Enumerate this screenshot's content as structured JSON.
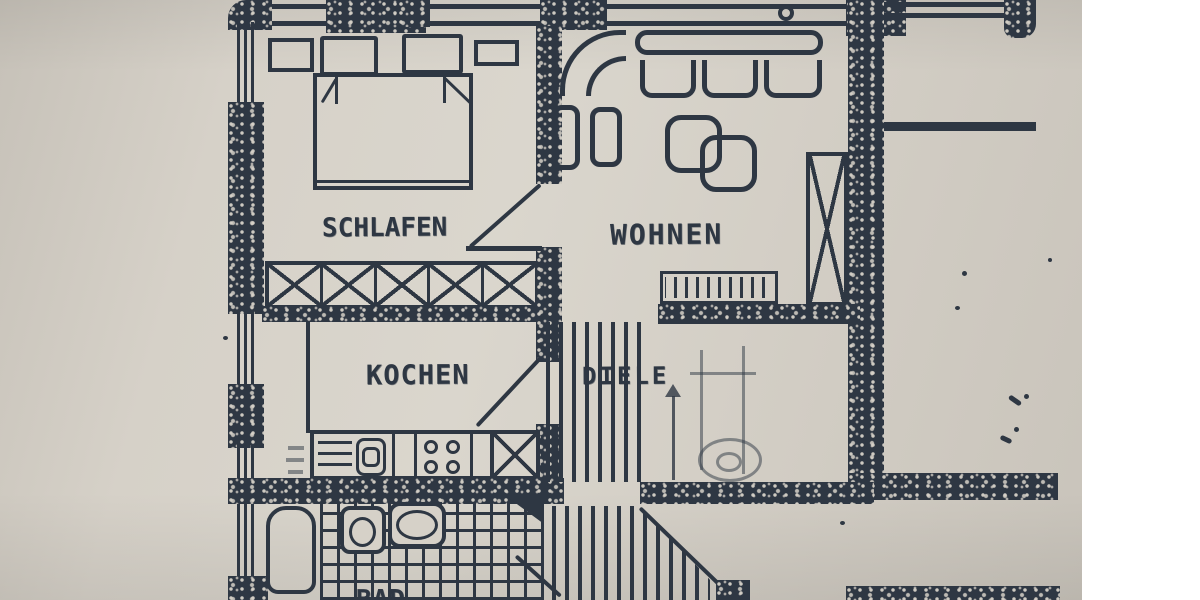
{
  "document": {
    "kind": "scanned-floor-plan-photo",
    "language": "de",
    "scan_margin_side": "right"
  },
  "colors": {
    "paper": "#d6d1c8",
    "paper2": "#c8c3ba",
    "ink": "#2e3743",
    "inkfaint": "#5c636e",
    "white": "#ffffff"
  },
  "rooms": {
    "schlafen": {
      "label": "SCHLAFEN"
    },
    "wohnen": {
      "label": "WOHNEN"
    },
    "kochen": {
      "label": "KOCHEN"
    },
    "diele": {
      "label": "DIELE"
    },
    "bad": {
      "label": "BAD"
    }
  },
  "furniture": {
    "schlafen": [
      "double-bed",
      "mattresses",
      "pillows",
      "nightstand-left",
      "nightstand-right",
      "built-in-wardrobe-x-row"
    ],
    "wohnen": [
      "corner-sofa",
      "seat-cushions",
      "armchair-pair",
      "overlapping-coffee-tables",
      "tall-x-cabinet-or-shaft",
      "radiator"
    ],
    "kochen": [
      "kitchen-counter",
      "drainboard",
      "sink",
      "stove-four-burners",
      "fridge-or-shaft-x-box"
    ],
    "diele": [
      "staircase-upper-flight",
      "staircase-lower-flight",
      "stair-direction-arrow",
      "faint-pencil-sketch"
    ],
    "bad": [
      "bathtub",
      "toilet",
      "washbasin",
      "tiled-floor"
    ]
  },
  "architecture": [
    "speckled-masonry-walls",
    "window-bands-left-and-top",
    "door-swing-lines",
    "balcony-railing-top-right"
  ]
}
